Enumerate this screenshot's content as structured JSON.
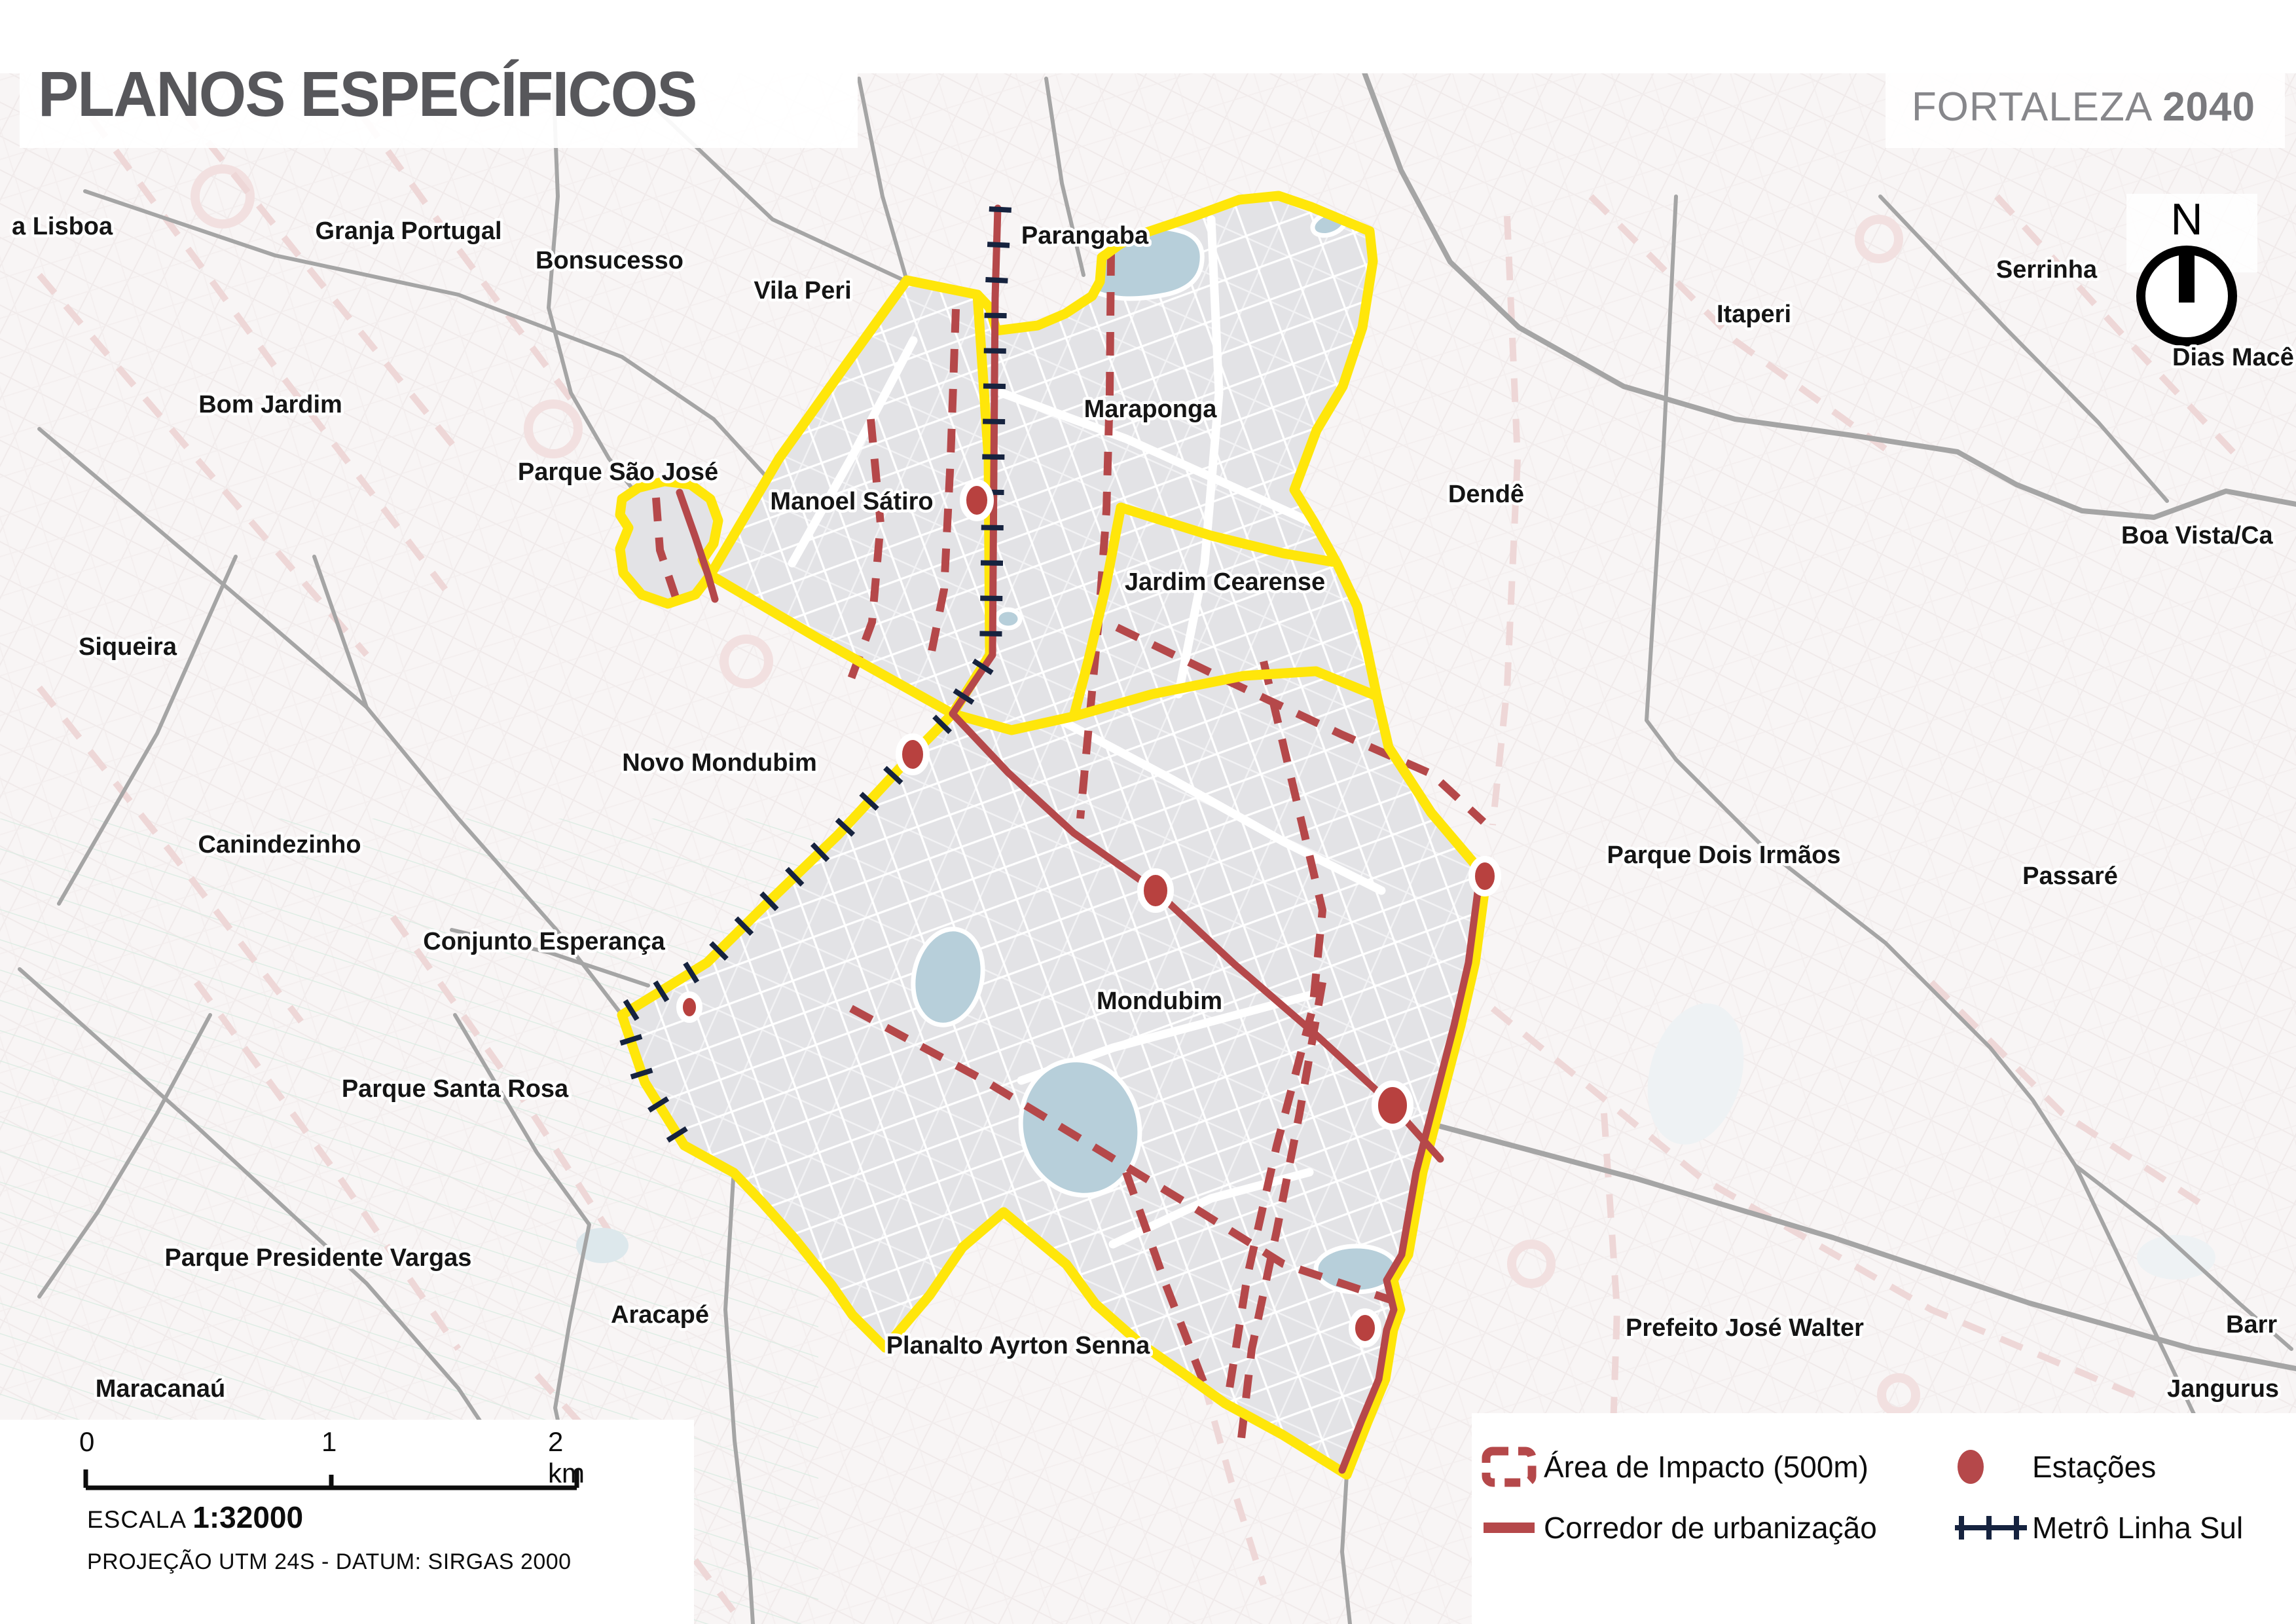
{
  "header": {
    "title": "PLANOS ESPECÍFICOS",
    "brand_name": "FORTALEZA",
    "brand_year": "2040"
  },
  "compass": {
    "north_label": "N"
  },
  "scalebar": {
    "tick0": "0",
    "tick1": "1",
    "tick2": "2 km",
    "escala_label": "ESCALA",
    "escala_value": "1:32000",
    "projection": "PROJEÇÃO UTM 24S - DATUM: SIRGAS 2000"
  },
  "legend": {
    "impact_area": "Área de Impacto (500m)",
    "stations": "Estações",
    "corridor": "Corredor de urbanização",
    "metro": "Metrô Linha Sul"
  },
  "map": {
    "labels": [
      {
        "text": "a Lisboa"
      },
      {
        "text": "Granja Portugal"
      },
      {
        "text": "Bonsucesso"
      },
      {
        "text": "Vila Peri"
      },
      {
        "text": "Parangaba"
      },
      {
        "text": "Serrinha"
      },
      {
        "text": "Itaperi"
      },
      {
        "text": "Dias Macê"
      },
      {
        "text": "Bom Jardim"
      },
      {
        "text": "Maraponga"
      },
      {
        "text": "Boa Vista/Ca"
      },
      {
        "text": "Parque São José"
      },
      {
        "text": "Manoel Sátiro"
      },
      {
        "text": "Dendê"
      },
      {
        "text": "Jardim Cearense"
      },
      {
        "text": "Siqueira"
      },
      {
        "text": "Novo Mondubim"
      },
      {
        "text": "Parque Dois Irmãos"
      },
      {
        "text": "Passaré"
      },
      {
        "text": "Canindezinho"
      },
      {
        "text": "Conjunto Esperança"
      },
      {
        "text": "Mondubim"
      },
      {
        "text": "Parque Santa Rosa"
      },
      {
        "text": "Parque Presidente Vargas"
      },
      {
        "text": "Aracapé"
      },
      {
        "text": "Planalto Ayrton Senna"
      },
      {
        "text": "Prefeito José Walter"
      },
      {
        "text": "Maracanaú"
      },
      {
        "text": "Barr"
      },
      {
        "text": "Jangurus"
      }
    ],
    "station_count": 7,
    "colors": {
      "boundary_yellow": "#ffe60a",
      "corridor_red": "#b5484a",
      "metro_navy": "#16233f",
      "district_gray": "#e3e3e6",
      "admin_gray": "#a5a5a5",
      "lake_blue": "#b7cfda",
      "outside_pink_dash": "#eed7d7"
    }
  }
}
